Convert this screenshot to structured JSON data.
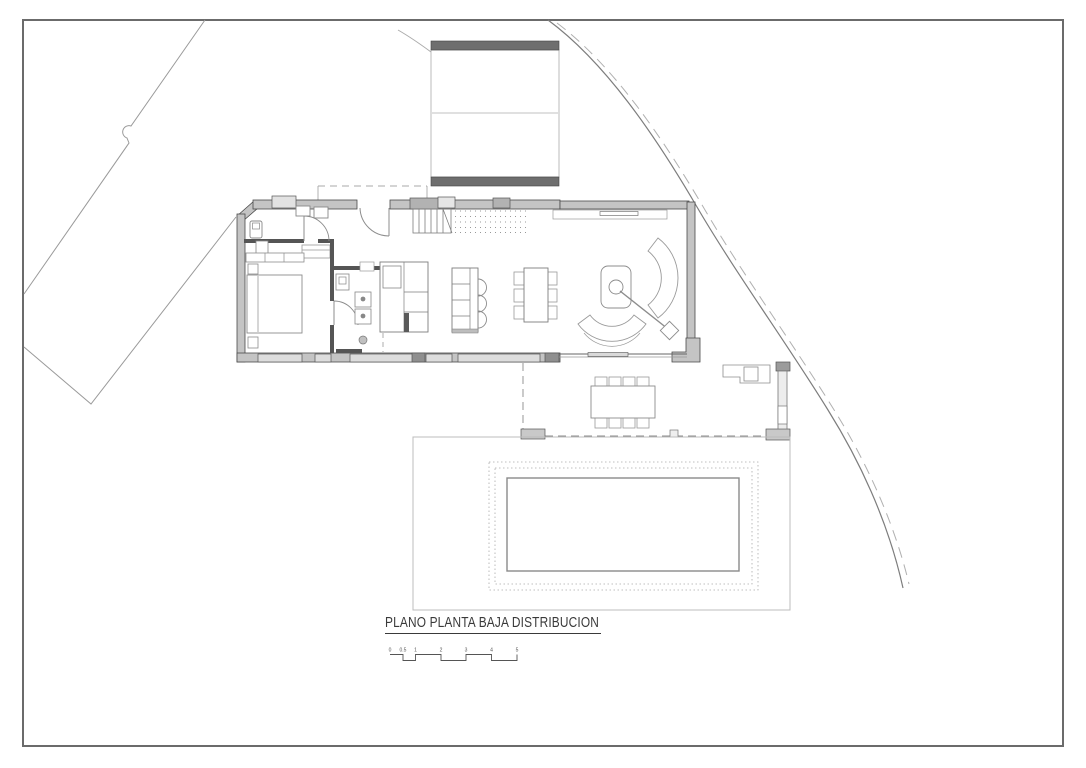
{
  "page": {
    "title": "PLANO PLANTA BAJA DISTRIBUCION",
    "kind": "architectural-floor-plan-ground-floor"
  },
  "scale_bar": {
    "labels": [
      "0",
      "0.5",
      "1",
      "2",
      "3",
      "4",
      "5"
    ],
    "unit": "m"
  },
  "colors": {
    "paper": "#ffffff",
    "ink": "#3a3a3a",
    "frame": "#6b6b6b",
    "wall_fill": "#c4c4c4",
    "wall_edge": "#4a4a4a",
    "dark_band": "#6e6e6e",
    "window_fill": "#dcdcdc",
    "furniture_line": "#8c8c8c",
    "site_line": "#9a9a9a",
    "dashed_line": "#a8a8a8",
    "pool_line": "#8a8a8a"
  }
}
